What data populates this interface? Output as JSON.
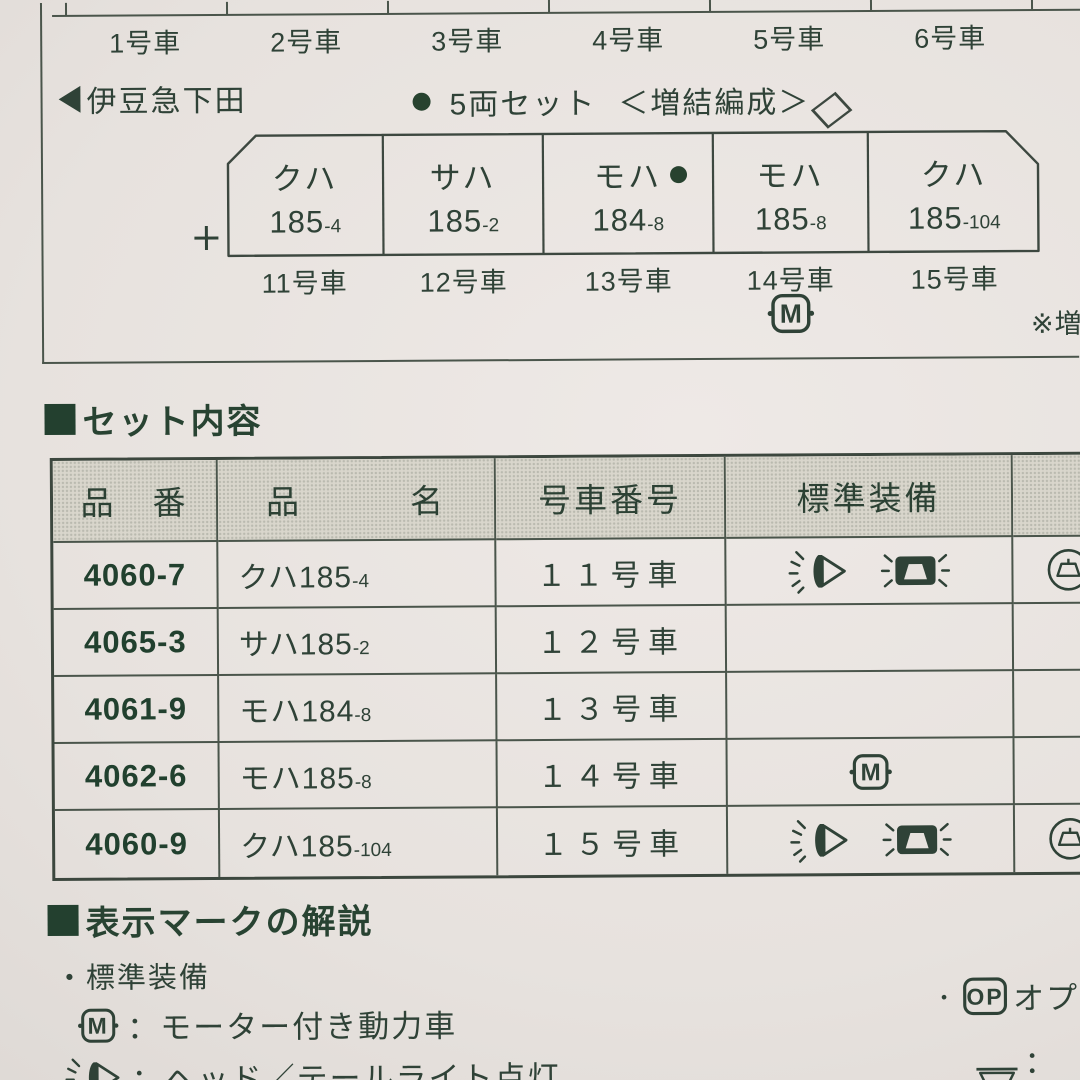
{
  "colors": {
    "paper": "#e7e2de",
    "ink": "#2f4237",
    "ink_bold": "#21402e",
    "table_line": "#4a554b",
    "header_fill": "#d9d6cc"
  },
  "top_diagram": {
    "upper_car_labels": [
      "1号車",
      "2号車",
      "3号車",
      "4号車",
      "5号車",
      "6号車"
    ],
    "destination": "伊豆急下田",
    "set_label": "5両セット",
    "formation_label": "＜増結編成＞",
    "cars": [
      {
        "series": "クハ",
        "number": "185",
        "suffix": "-4",
        "car_no": "11号車"
      },
      {
        "series": "サハ",
        "number": "185",
        "suffix": "-2",
        "car_no": "12号車"
      },
      {
        "series": "モハ",
        "number": "184",
        "suffix": "-8",
        "car_no": "13号車"
      },
      {
        "series": "モハ",
        "number": "185",
        "suffix": "-8",
        "car_no": "14号車"
      },
      {
        "series": "クハ",
        "number": "185",
        "suffix": "-104",
        "car_no": "15号車"
      }
    ],
    "motor_badge": "M",
    "pantograph_icon": "diamond",
    "coupler_icon": "plus",
    "note": "※増"
  },
  "set_contents": {
    "heading": "セット内容",
    "columns": [
      "品　番",
      "品　　　名",
      "号車番号",
      "標準装備"
    ],
    "rows": [
      {
        "part_no": "4060-7",
        "name": "クハ185",
        "suffix": "-4",
        "car": "１１号車",
        "standard_equipment": [
          "headlight",
          "taillight"
        ],
        "option": "interior-light"
      },
      {
        "part_no": "4065-3",
        "name": "サハ185",
        "suffix": "-2",
        "car": "１２号車",
        "standard_equipment": [],
        "option": "（"
      },
      {
        "part_no": "4061-9",
        "name": "モハ184",
        "suffix": "-8",
        "car": "１３号車",
        "standard_equipment": [],
        "option": ""
      },
      {
        "part_no": "4062-6",
        "name": "モハ185",
        "suffix": "-8",
        "car": "１４号車",
        "standard_equipment": [
          "motor"
        ],
        "option": ""
      },
      {
        "part_no": "4060-9",
        "name": "クハ185",
        "suffix": "-104",
        "car": "１５号車",
        "standard_equipment": [
          "headlight",
          "taillight"
        ],
        "option": "interior-light"
      }
    ]
  },
  "legend": {
    "heading": "表示マークの解説",
    "standard_label": "・標準装備",
    "motor_text": "：モーター付き動力車",
    "light_text": "：ヘッド／テールライト点灯",
    "option_bullet": "・",
    "op_badge": "OP",
    "option_text": "オプ",
    "interior_text": "：室"
  }
}
